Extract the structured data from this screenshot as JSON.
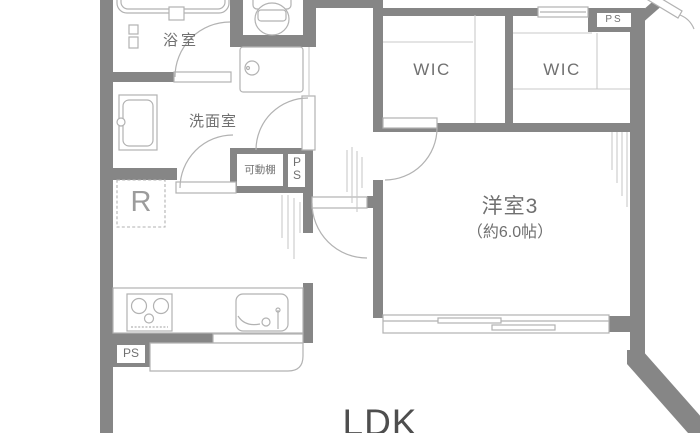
{
  "floorplan": {
    "rooms": {
      "bathroom": {
        "label": "浴室"
      },
      "washroom": {
        "label": "洗面室"
      },
      "wic_left": {
        "label": "WIC"
      },
      "wic_right": {
        "label": "WIC"
      },
      "western_room3": {
        "label": "洋室3",
        "size": "（約6.0帖）"
      },
      "ldk": {
        "label": "LDK"
      }
    },
    "annotations": {
      "refrigerator": "R",
      "movable_shelf": "可動棚",
      "pipe_space_hall": "PS",
      "pipe_space_entrance": "PS",
      "pipe_space_kitchen": "PS"
    },
    "colors": {
      "wall": "#868686",
      "line": "#b2b2b2",
      "line-light": "#c9c9c9",
      "text": "#707070",
      "text-light": "#9c9c9c",
      "text-dark": "#4e4e4e",
      "background": "#ffffff"
    }
  }
}
